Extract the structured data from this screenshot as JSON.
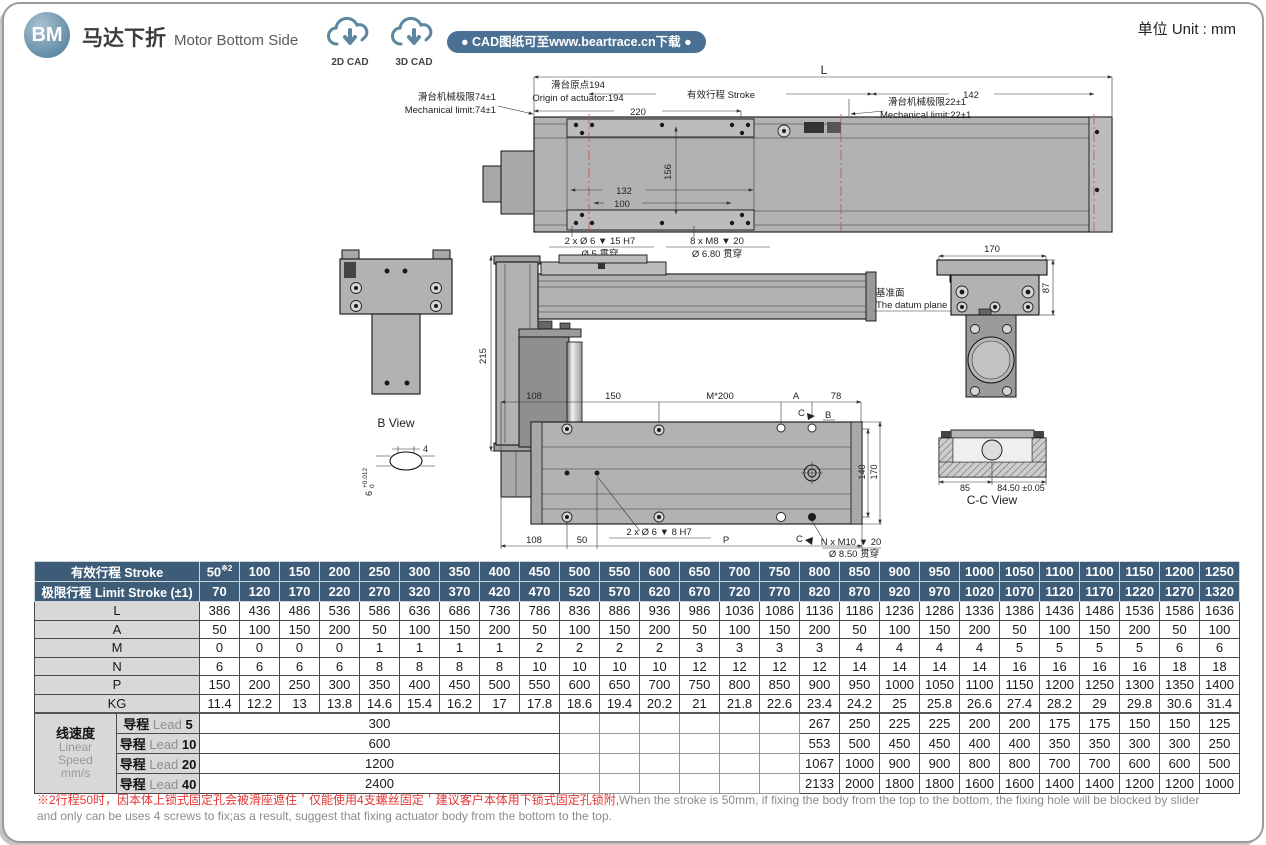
{
  "colors": {
    "header_blue": "#3d5c78",
    "banner_blue": "#4a7193",
    "badge_blue": "#618aa4",
    "label_gray": "#d8d8d8",
    "note_red": "#e53535",
    "centerline_red": "#d24a4a",
    "drawing_gray": "#b2b2b2"
  },
  "header": {
    "badge": "BM",
    "title_zh": "马达下折",
    "title_en": "Motor Bottom Side",
    "cad_2d": "2D CAD",
    "cad_3d": "3D CAD",
    "banner": "● CAD图纸可至www.beartrace.cn下载 ●",
    "unit": "单位 Unit : mm"
  },
  "drawing": {
    "top_view": {
      "dim_l": "L",
      "origin_zh": "滑台原点194",
      "origin_en": "Origin of actuator:194",
      "stroke_dim": "有效行程 Stroke",
      "dim_142": "142",
      "dim_220": "220",
      "limit_left_zh": "滑台机械极限74±1",
      "limit_left_en": "Mechanical limit:74±1",
      "limit_right_zh": "滑台机械极限22±1",
      "limit_right_en": "Mechanical limit:22±1",
      "dim_132": "132",
      "dim_100": "100",
      "dim_156": "156",
      "pin_callout_1": "2 x Ø 6 ▼ 15 H7",
      "pin_callout_2": "Ø 5 贯穿",
      "m8_callout_1": "8 x M8 ▼ 20",
      "m8_callout_2": "Ø 6.80 贯穿"
    },
    "b_view": {
      "title": "B View",
      "dim_4": "4",
      "dim_6": "6",
      "tol_plus": "+0.012",
      "tol_zero": "0"
    },
    "side_view": {
      "dim_215": "215",
      "datum_zh": "基准面",
      "datum_en": "The datum plane"
    },
    "end_view": {
      "dim_170": "170",
      "dim_87": "87"
    },
    "bottom_view": {
      "dim_108_top": "108",
      "dim_150": "150",
      "dim_m200": "M*200",
      "dim_a": "A",
      "dim_78": "78",
      "mark_c_top": "C",
      "mark_b": "B",
      "mark_c_bottom": "C",
      "dim_140": "140",
      "dim_170": "170",
      "dim_108_bottom": "108",
      "dim_50": "50",
      "dim_p": "P",
      "pin_callout": "2 x Ø 6 ▼ 8 H7",
      "m10_callout_1": "N x M10 ▼ 20",
      "m10_callout_2": "Ø 8.50 贯穿"
    },
    "cc_view": {
      "title": "C-C View",
      "dim_85": "85",
      "dim_8450": "84.50 ±0.05"
    }
  },
  "table": {
    "header": {
      "stroke_label": "有效行程 Stroke",
      "stroke_note": "※2",
      "limit_label": "极限行程 Limit Stroke (±1)"
    },
    "strokes": [
      "50",
      "100",
      "150",
      "200",
      "250",
      "300",
      "350",
      "400",
      "450",
      "500",
      "550",
      "600",
      "650",
      "700",
      "750",
      "800",
      "850",
      "900",
      "950",
      "1000",
      "1050",
      "1100",
      "1100",
      "1150",
      "1200",
      "1250"
    ],
    "limits": [
      "70",
      "120",
      "170",
      "220",
      "270",
      "320",
      "370",
      "420",
      "470",
      "520",
      "570",
      "620",
      "670",
      "720",
      "770",
      "820",
      "870",
      "920",
      "970",
      "1020",
      "1070",
      "1120",
      "1170",
      "1220",
      "1270",
      "1320"
    ],
    "rows": [
      {
        "label": "L",
        "values": [
          "386",
          "436",
          "486",
          "536",
          "586",
          "636",
          "686",
          "736",
          "786",
          "836",
          "886",
          "936",
          "986",
          "1036",
          "1086",
          "1136",
          "1186",
          "1236",
          "1286",
          "1336",
          "1386",
          "1436",
          "1486",
          "1536",
          "1586",
          "1636"
        ]
      },
      {
        "label": "A",
        "values": [
          "50",
          "100",
          "150",
          "200",
          "50",
          "100",
          "150",
          "200",
          "50",
          "100",
          "150",
          "200",
          "50",
          "100",
          "150",
          "200",
          "50",
          "100",
          "150",
          "200",
          "50",
          "100",
          "150",
          "200",
          "50",
          "100"
        ]
      },
      {
        "label": "M",
        "values": [
          "0",
          "0",
          "0",
          "0",
          "1",
          "1",
          "1",
          "1",
          "2",
          "2",
          "2",
          "2",
          "3",
          "3",
          "3",
          "3",
          "4",
          "4",
          "4",
          "4",
          "5",
          "5",
          "5",
          "5",
          "6",
          "6"
        ]
      },
      {
        "label": "N",
        "values": [
          "6",
          "6",
          "6",
          "6",
          "8",
          "8",
          "8",
          "8",
          "10",
          "10",
          "10",
          "10",
          "12",
          "12",
          "12",
          "12",
          "14",
          "14",
          "14",
          "14",
          "16",
          "16",
          "16",
          "16",
          "18",
          "18"
        ]
      },
      {
        "label": "P",
        "values": [
          "150",
          "200",
          "250",
          "300",
          "350",
          "400",
          "450",
          "500",
          "550",
          "600",
          "650",
          "700",
          "750",
          "800",
          "850",
          "900",
          "950",
          "1000",
          "1050",
          "1100",
          "1150",
          "1200",
          "1250",
          "1300",
          "1350",
          "1400"
        ]
      },
      {
        "label": "KG",
        "values": [
          "11.4",
          "12.2",
          "13",
          "13.8",
          "14.6",
          "15.4",
          "16.2",
          "17",
          "17.8",
          "18.6",
          "19.4",
          "20.2",
          "21",
          "21.8",
          "22.6",
          "23.4",
          "24.2",
          "25",
          "25.8",
          "26.6",
          "27.4",
          "28.2",
          "29",
          "29.8",
          "30.6",
          "31.4"
        ]
      }
    ],
    "speed": {
      "zh": "线速度",
      "en": [
        "Linear",
        "Speed",
        "mm/s"
      ],
      "lead_zh": "导程",
      "lead_word": "Lead",
      "merged_span": 9,
      "empty_span": 6,
      "rows": [
        {
          "num": "5",
          "merged": "300",
          "tail": [
            "267",
            "250",
            "225",
            "225",
            "200",
            "200",
            "175",
            "175",
            "150",
            "150",
            "125"
          ]
        },
        {
          "num": "10",
          "merged": "600",
          "tail": [
            "553",
            "500",
            "450",
            "450",
            "400",
            "400",
            "350",
            "350",
            "300",
            "300",
            "250"
          ]
        },
        {
          "num": "20",
          "merged": "1200",
          "tail": [
            "1067",
            "1000",
            "900",
            "900",
            "800",
            "800",
            "700",
            "700",
            "600",
            "600",
            "500"
          ]
        },
        {
          "num": "40",
          "merged": "2400",
          "tail": [
            "2133",
            "2000",
            "1800",
            "1800",
            "1600",
            "1600",
            "1400",
            "1400",
            "1200",
            "1200",
            "1000"
          ]
        }
      ]
    }
  },
  "footnote": {
    "zh": "※2行程50时，因本体上锁式固定孔会被滑座遮住＇仅能使用4支螺丝固定＇建议客户本体用下锁式固定孔锁附,",
    "en1": "When the stroke is 50mm, if fixing the body from the top to the bottom, the fixing hole will be blocked by slider",
    "en2": "and only can be uses 4 screws to fix;as a result, suggest that fixing actuator body from the bottom to the top."
  }
}
